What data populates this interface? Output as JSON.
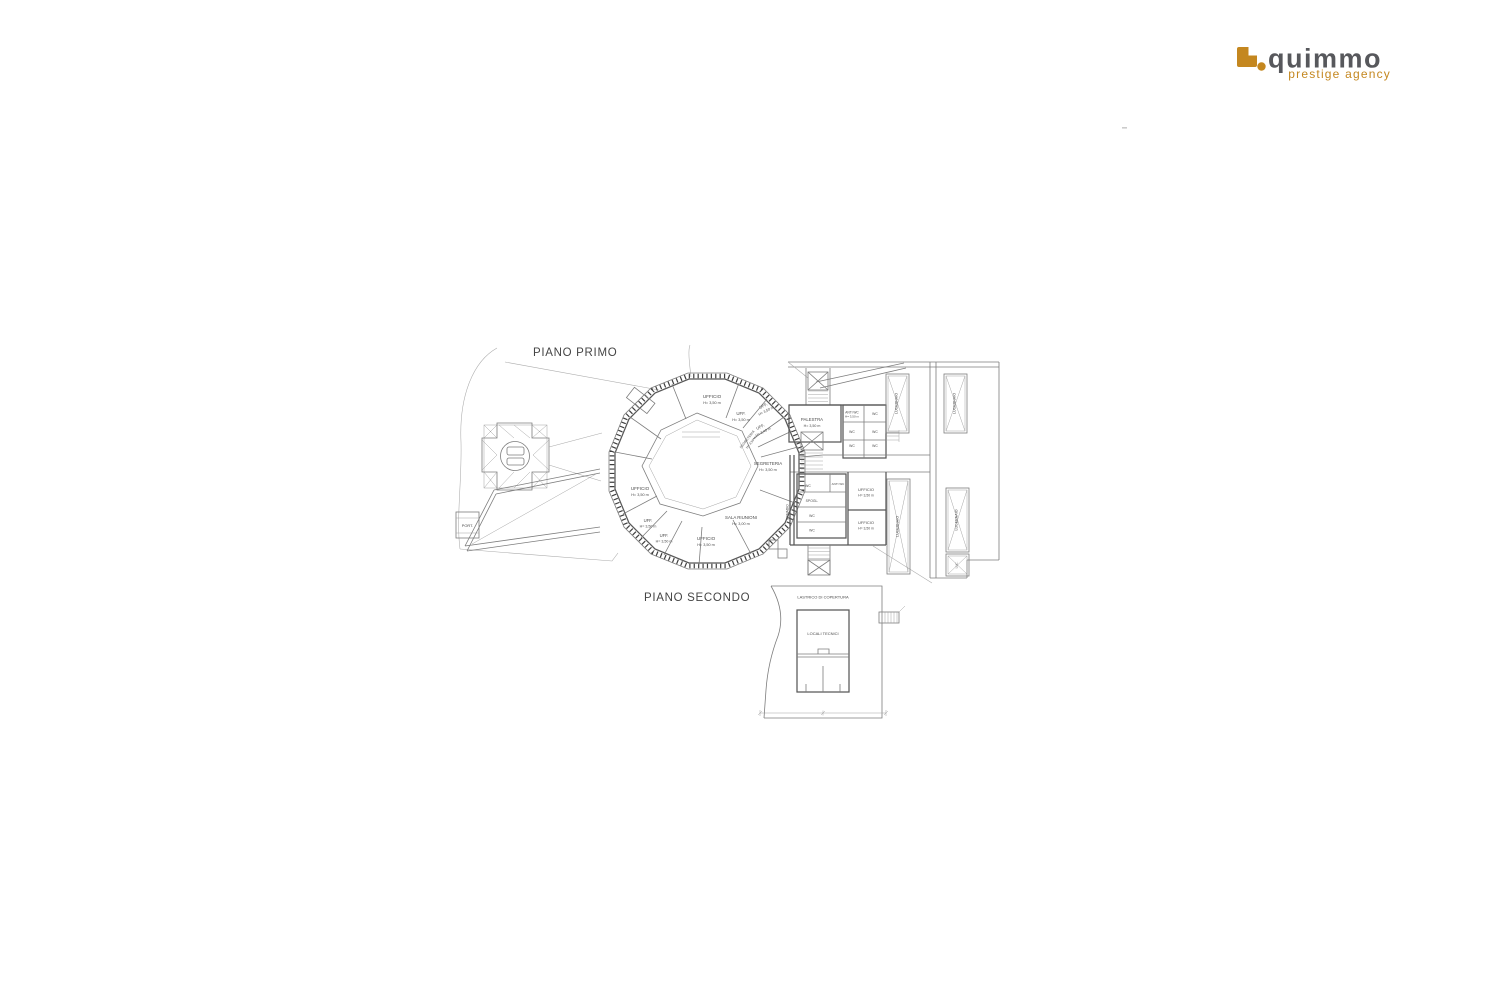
{
  "page": {
    "background": "#ffffff"
  },
  "logo": {
    "brand": "quimmo",
    "tagline": "prestige agency",
    "brand_color": "#57585C",
    "accent_color": "#C4871F"
  },
  "floor_plans": {
    "first_floor": {
      "title": "PIANO PRIMO",
      "rooms": [
        {
          "n": "UFFICIO",
          "h": "H= 3,50 m"
        },
        {
          "n": "UFF.",
          "h": "H= 3,50 m"
        },
        {
          "n": "UFF.",
          "h": "H= 3,50 m"
        },
        {
          "n": "UFF.",
          "h": "H= 3,40 m"
        },
        {
          "n": "SEGRETERIA",
          "h": "H= 3,50 m"
        },
        {
          "n": "SEGRETERIA",
          "h": "H= 3,50 m"
        },
        {
          "n": "UFFICIO",
          "h": "H= 3,50 m"
        },
        {
          "n": "UFF.",
          "h": "H= 3,50 m"
        },
        {
          "n": "UFF.",
          "h": "H= 3,50 m"
        },
        {
          "n": "UFFICIO",
          "h": "H= 3,50 m"
        },
        {
          "n": "SALA RIUNIONI",
          "h": "H= 3,00 m"
        }
      ],
      "wing": {
        "palestra": "PALESTRA",
        "palestra_h": "H= 3,50 m",
        "anti_wc": "ANTI WC",
        "anti_wc_h": "H= 3,50 m",
        "wc": "WC",
        "spogl": "SPOGL.",
        "armadio": "ARMADIO",
        "ufficio": "UFFICIO",
        "ufficio_h": "H= 3,50 m",
        "lucernaio": "LUCERNAIO",
        "luc": "LUC.",
        "port": "PORT."
      }
    },
    "second_floor": {
      "title": "PIANO SECONDO",
      "lastrico": "LASTRICO DI COPERTURA",
      "locali": "LOCALI TECNICI"
    }
  }
}
